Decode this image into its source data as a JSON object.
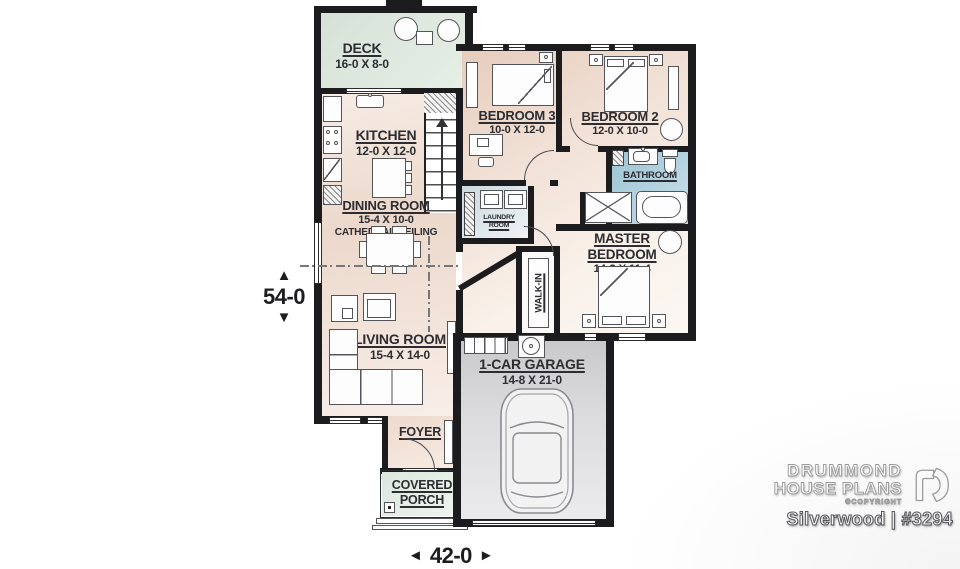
{
  "title": "Silverwood floor plan",
  "rooms": {
    "deck": {
      "name": "DECK",
      "size": "16-0 X 8-0"
    },
    "kitchen": {
      "name": "KITCHEN",
      "size": "12-0 X 12-0"
    },
    "dining": {
      "name": "DINING ROOM",
      "size": "15-4 X 10-0",
      "note": "CATHEDRAL CEILING"
    },
    "living": {
      "name": "LIVING ROOM",
      "size": "15-4 X 14-0"
    },
    "bedroom3": {
      "name": "BEDROOM 3",
      "size": "10-0 X 12-0"
    },
    "bedroom2": {
      "name": "BEDROOM 2",
      "size": "12-0 X 10-0"
    },
    "bathroom": {
      "name": "BATHROOM"
    },
    "laundry": {
      "line1": "LAUNDRY",
      "line2": "ROOM"
    },
    "master": {
      "line1": "MASTER",
      "line2": "BEDROOM",
      "size": "14-2 X 11-4"
    },
    "walkin": {
      "name": "WALK-IN"
    },
    "garage": {
      "name": "1-CAR GARAGE",
      "size": "14-8 X 21-0"
    },
    "foyer": {
      "name": "FOYER"
    },
    "porch": {
      "line1": "COVERED",
      "line2": "PORCH"
    }
  },
  "dimensions": {
    "height": {
      "value": "54-0",
      "arrow_up": "▲",
      "arrow_down": "▼"
    },
    "width": {
      "value": "42-0",
      "arrow_left": "◄",
      "arrow_right": "►"
    }
  },
  "brand": {
    "line1": "DRUMMOND",
    "line2": "HOUSE PLANS",
    "copyright": "©COPYRIGHT",
    "plan_id": "Silverwood | #3294"
  },
  "colors": {
    "wall": "#1c1c1e",
    "deck": "#d9e4da",
    "porch": "#dfe9e0",
    "bathroom": "#a3c8d7",
    "garage_floor": "#d2d2d5",
    "floor_tan": "#e3cabb",
    "label_text": "#2c2c31"
  }
}
